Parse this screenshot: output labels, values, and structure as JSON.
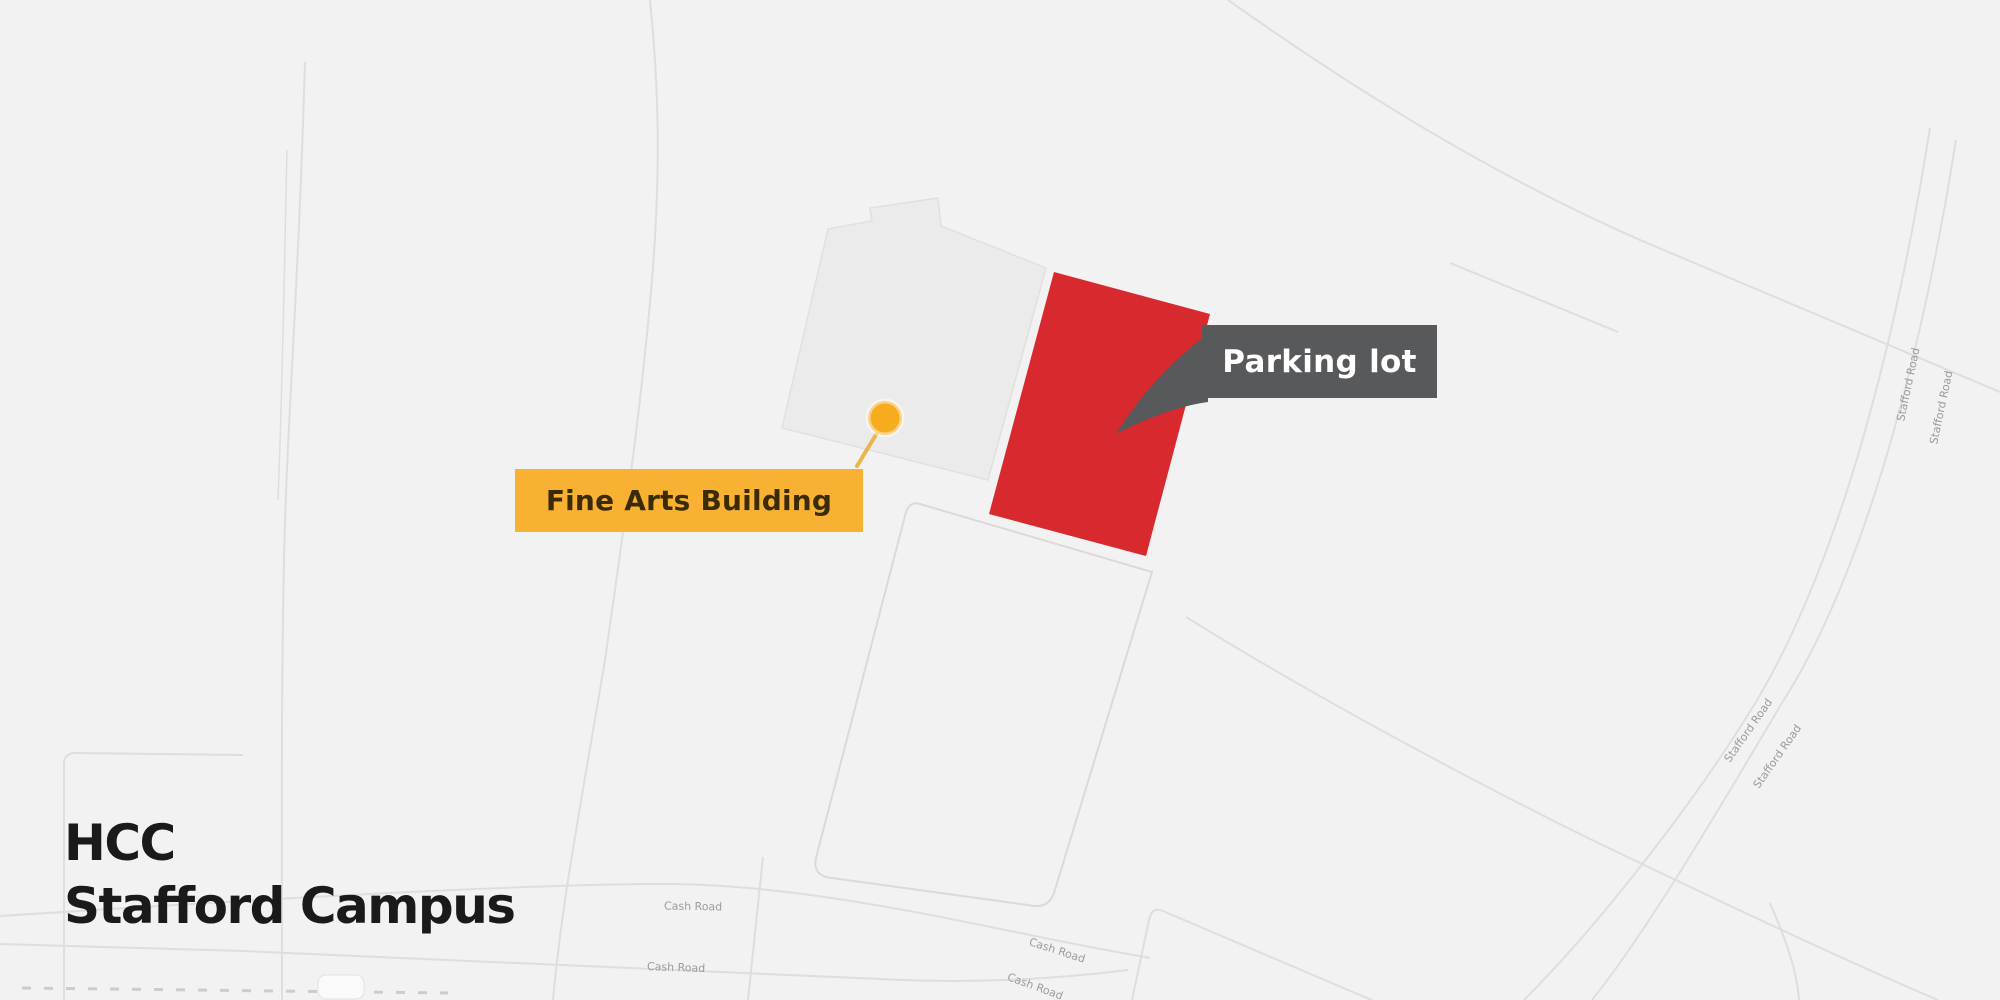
{
  "title": {
    "line1": "HCC",
    "line2": "Stafford Campus"
  },
  "callouts": {
    "fine_arts": {
      "label": "Fine Arts Building",
      "bg_color": "#F8B133",
      "text_color": "#3B2B05"
    },
    "parking": {
      "label": "Parking lot",
      "bg_color": "#58595B",
      "text_color": "#FFFFFF"
    }
  },
  "map": {
    "background_color": "#F3F2F2",
    "road_color": "#DFDDDD",
    "parcel_stroke": "#DBD9D9",
    "building_fill": "#ECEBEB",
    "building_stroke": "#E1DFDF",
    "highlight_color": "#D8292F",
    "pin_color": "#F7AC1E",
    "road_label_color": "#9B9B9B",
    "road_names": {
      "cash": "Cash Road",
      "stafford": "Stafford Road"
    }
  }
}
